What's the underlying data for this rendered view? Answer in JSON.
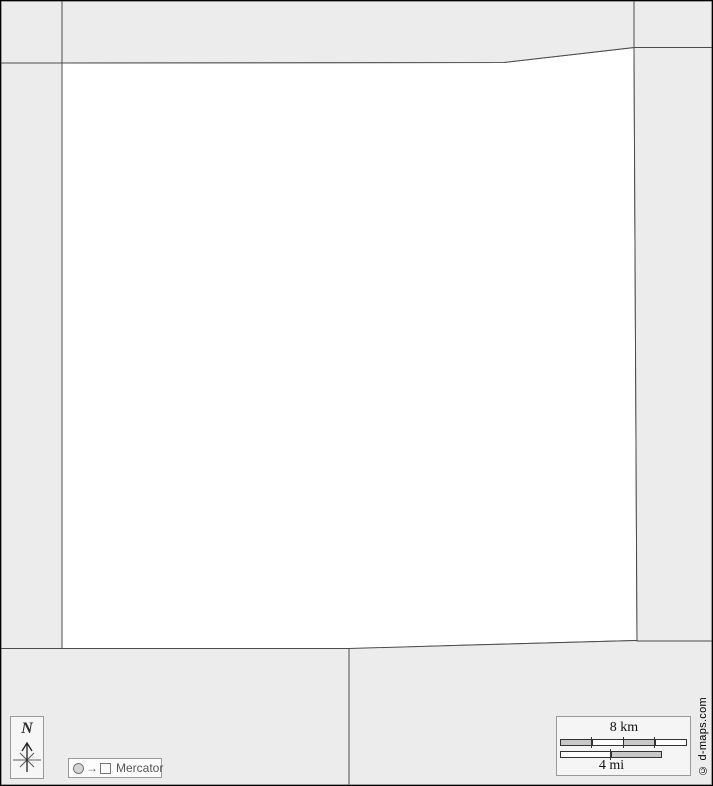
{
  "compass": {
    "north_label": "N"
  },
  "projection_legend": {
    "arrow_glyph": "→",
    "label": "Mercator"
  },
  "scale_legend": {
    "km_label": "8 km",
    "mi_label": "4 mi"
  },
  "copyright_label": "© d-maps.com",
  "colors": {
    "neighbor_region_fill": "#ececec",
    "focus_region_fill": "#ffffff",
    "region_border": "#4c4c4c",
    "frame_border": "#000000",
    "scale_segment_gray": "#c8c8c8",
    "scale_segment_white": "#ffffff"
  }
}
